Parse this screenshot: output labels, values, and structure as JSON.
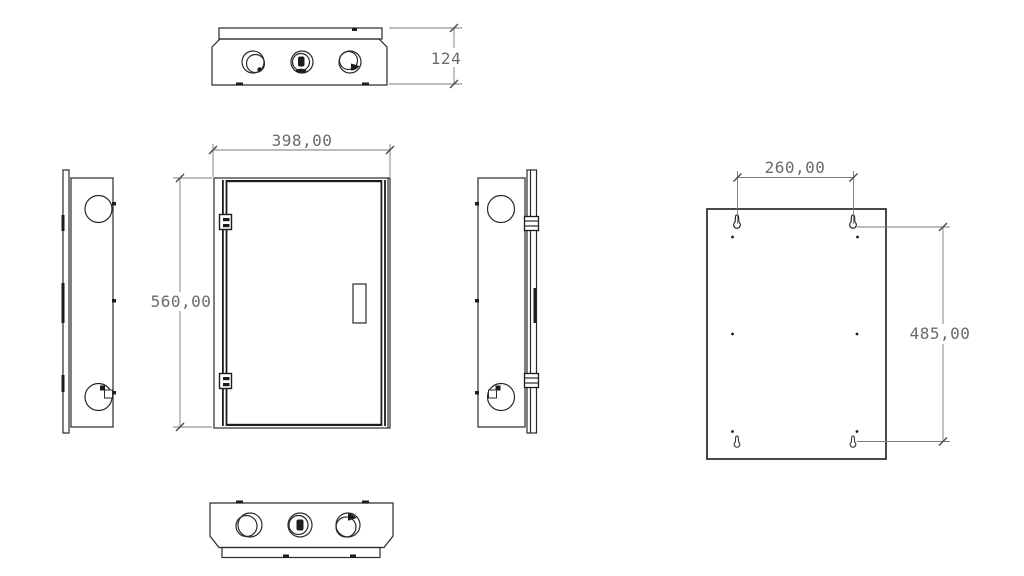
{
  "drawing": {
    "type": "technical-drawing-enclosure",
    "background_color": "#ffffff",
    "object_line_color": "#2a2a2a",
    "dimension_line_color": "#7a7a7a",
    "dimension_text_color": "#6b6b6b",
    "dimensions": {
      "depth": "124",
      "width": "398,00",
      "height": "560,00",
      "mounting_hole_spacing_horizontal": "260,00",
      "mounting_hole_spacing_vertical": "485,00"
    },
    "views": {
      "top": {
        "knockout_hole_count": 3
      },
      "front": {
        "hinge_count": 2,
        "handle_count": 1
      },
      "left_side": {
        "hole_count": 2
      },
      "right_side": {
        "hole_count": 2
      },
      "bottom": {
        "knockout_hole_count": 3
      },
      "back_mounting": {
        "keyhole_slot_count": 4,
        "pilot_dot_count": 6
      }
    }
  }
}
